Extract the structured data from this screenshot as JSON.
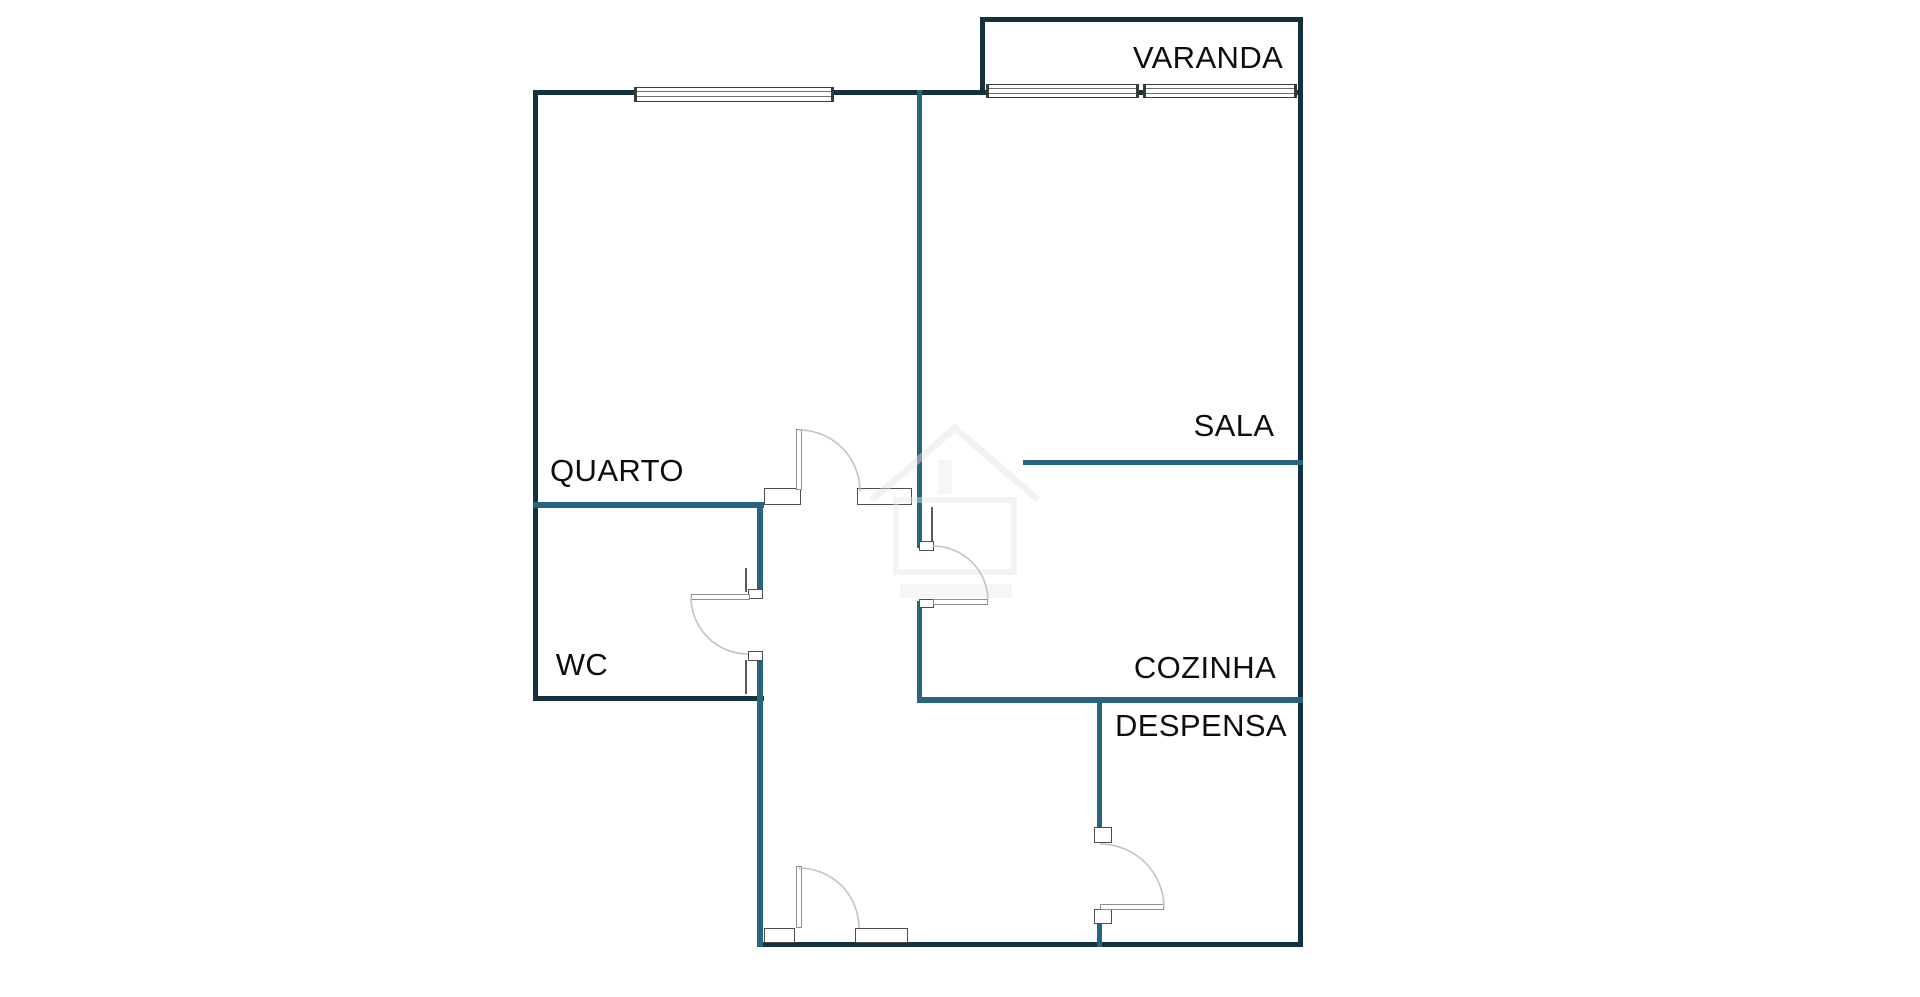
{
  "plan": {
    "type": "apartment-floor-plan",
    "rooms": {
      "varanda": {
        "label": "VARANDA"
      },
      "quarto": {
        "label": "QUARTO"
      },
      "wc": {
        "label": "WC"
      },
      "sala": {
        "label": "SALA"
      },
      "cozinha": {
        "label": "COZINHA"
      },
      "despensa": {
        "label": "DESPENSA"
      }
    },
    "colors": {
      "exterior_wall": "#14313f",
      "interior_wall": "#26647f",
      "label_text": "#0d0d0d",
      "background": "#ffffff"
    }
  }
}
